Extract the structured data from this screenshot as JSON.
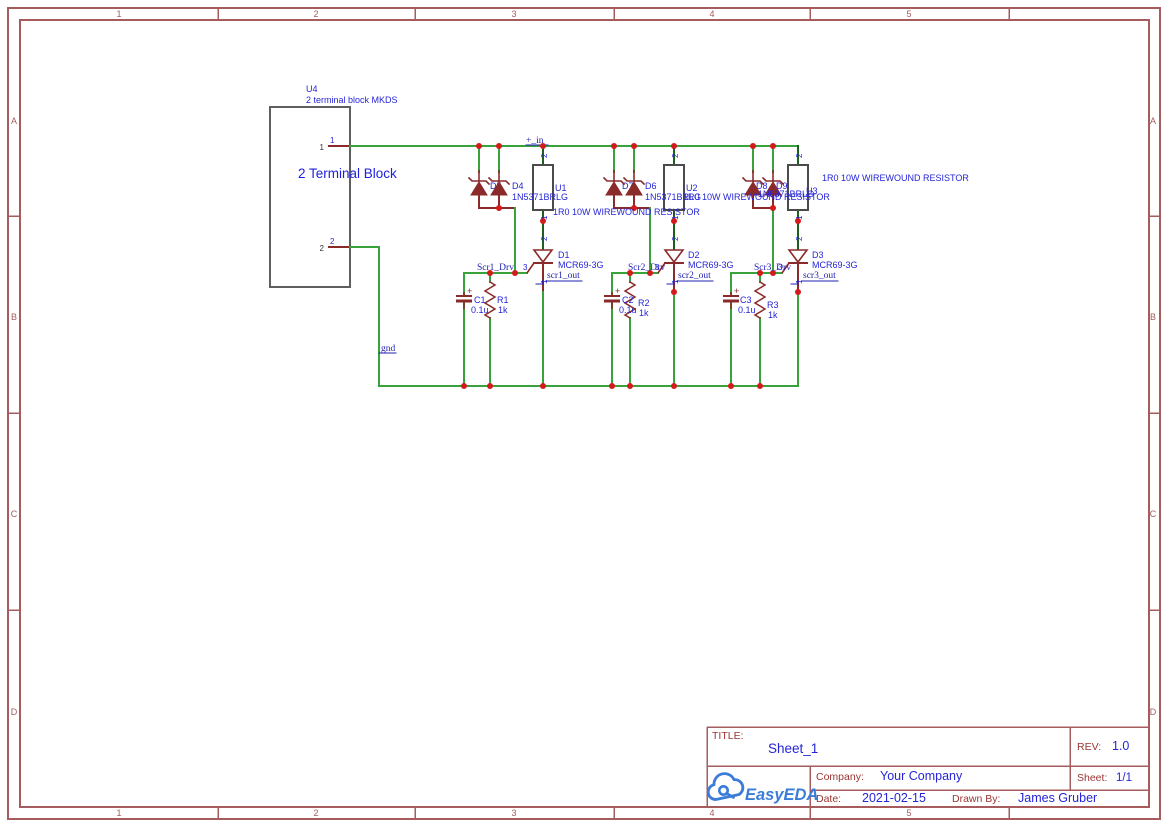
{
  "frame": {
    "columns": [
      "1",
      "2",
      "3",
      "4",
      "5"
    ],
    "rows": [
      "A",
      "B",
      "C",
      "D"
    ],
    "col_ticks": [
      218,
      415,
      614,
      810,
      1009
    ],
    "col_centers": [
      119,
      316,
      514,
      712,
      909
    ],
    "row_ticks": [
      216,
      413,
      610
    ],
    "row_centers": [
      121,
      317,
      514,
      712
    ],
    "color": "#a65c5c"
  },
  "title_block": {
    "title_label": "TITLE:",
    "title": "Sheet_1",
    "rev_label": "REV:",
    "rev": "1.0",
    "company_label": "Company:",
    "company": "Your Company",
    "sheet_label": "Sheet:",
    "sheet": "1/1",
    "date_label": "Date:",
    "date": "2021-02-15",
    "drawn_by_label": "Drawn By:",
    "drawn_by": "James Gruber",
    "logo_text": "EasyEDA"
  },
  "schematic": {
    "colors": {
      "wire": "#3aa23a",
      "dark": "#1e5e1e",
      "pin": "#8a2a2a",
      "junction": "#d41a1a",
      "lbl": "#2525d8",
      "lbl2": "#2020e0",
      "net": "#2222b2",
      "blk": "#333333",
      "box": "#4b4b4b",
      "body": "#5f5f5f"
    },
    "terminal_block": {
      "x": 270,
      "y": 107,
      "w": 80,
      "h": 180
    },
    "zeners": [
      479,
      499,
      614,
      634,
      753,
      773
    ],
    "scrs": [
      543,
      674,
      798
    ],
    "caps": [
      464,
      612,
      731
    ],
    "res_zigzag": [
      490,
      630,
      760
    ],
    "res_box": [
      543,
      674,
      798
    ],
    "wires": [
      {
        "c": "pin",
        "p": [
          [
            329,
            146
          ],
          [
            350,
            146
          ]
        ]
      },
      {
        "c": "pin",
        "p": [
          [
            329,
            247
          ],
          [
            350,
            247
          ]
        ]
      },
      {
        "c": "wire",
        "p": [
          [
            350,
            146
          ],
          [
            798,
            146
          ]
        ]
      },
      {
        "c": "wire",
        "p": [
          [
            350,
            247
          ],
          [
            379,
            247
          ],
          [
            379,
            386
          ],
          [
            798,
            386
          ]
        ]
      },
      {
        "c": "dark",
        "p": [
          [
            543,
            146
          ],
          [
            543,
            165
          ]
        ]
      },
      {
        "c": "dark",
        "p": [
          [
            674,
            146
          ],
          [
            674,
            165
          ]
        ]
      },
      {
        "c": "dark",
        "p": [
          [
            798,
            146
          ],
          [
            798,
            165
          ]
        ]
      },
      {
        "c": "dark",
        "p": [
          [
            543,
            210
          ],
          [
            543,
            250
          ]
        ]
      },
      {
        "c": "dark",
        "p": [
          [
            674,
            210
          ],
          [
            674,
            250
          ]
        ]
      },
      {
        "c": "dark",
        "p": [
          [
            798,
            210
          ],
          [
            798,
            250
          ]
        ]
      },
      {
        "c": "pin",
        "p": [
          [
            543,
            263
          ],
          [
            543,
            292
          ]
        ]
      },
      {
        "c": "pin",
        "p": [
          [
            674,
            263
          ],
          [
            674,
            292
          ]
        ]
      },
      {
        "c": "pin",
        "p": [
          [
            798,
            263
          ],
          [
            798,
            292
          ]
        ]
      },
      {
        "c": "wire",
        "p": [
          [
            543,
            292
          ],
          [
            543,
            386
          ]
        ]
      },
      {
        "c": "wire",
        "p": [
          [
            674,
            292
          ],
          [
            674,
            386
          ]
        ]
      },
      {
        "c": "wire",
        "p": [
          [
            798,
            292
          ],
          [
            798,
            386
          ]
        ]
      },
      {
        "c": "wire",
        "p": [
          [
            479,
            146
          ],
          [
            479,
            172
          ]
        ]
      },
      {
        "c": "wire",
        "p": [
          [
            499,
            146
          ],
          [
            499,
            172
          ]
        ]
      },
      {
        "c": "wire",
        "p": [
          [
            614,
            146
          ],
          [
            614,
            172
          ]
        ]
      },
      {
        "c": "wire",
        "p": [
          [
            634,
            146
          ],
          [
            634,
            172
          ]
        ]
      },
      {
        "c": "wire",
        "p": [
          [
            753,
            146
          ],
          [
            753,
            172
          ]
        ]
      },
      {
        "c": "wire",
        "p": [
          [
            773,
            146
          ],
          [
            773,
            172
          ]
        ]
      },
      {
        "c": "pin",
        "p": [
          [
            479,
            195
          ],
          [
            479,
            208
          ],
          [
            515,
            208
          ]
        ]
      },
      {
        "c": "pin",
        "p": [
          [
            499,
            195
          ],
          [
            499,
            208
          ]
        ]
      },
      {
        "c": "pin",
        "p": [
          [
            614,
            195
          ],
          [
            614,
            208
          ],
          [
            650,
            208
          ]
        ]
      },
      {
        "c": "pin",
        "p": [
          [
            634,
            195
          ],
          [
            634,
            208
          ]
        ]
      },
      {
        "c": "pin",
        "p": [
          [
            753,
            195
          ],
          [
            753,
            208
          ],
          [
            773,
            208
          ]
        ]
      },
      {
        "c": "pin",
        "p": [
          [
            773,
            195
          ],
          [
            773,
            208
          ]
        ]
      },
      {
        "c": "wire",
        "p": [
          [
            515,
            208
          ],
          [
            515,
            273
          ]
        ]
      },
      {
        "c": "wire",
        "p": [
          [
            650,
            208
          ],
          [
            650,
            273
          ]
        ]
      },
      {
        "c": "wire",
        "p": [
          [
            773,
            208
          ],
          [
            773,
            273
          ]
        ]
      },
      {
        "c": "wire",
        "p": [
          [
            464,
            273
          ],
          [
            527,
            273
          ]
        ]
      },
      {
        "c": "wire",
        "p": [
          [
            612,
            273
          ],
          [
            658,
            273
          ]
        ]
      },
      {
        "c": "wire",
        "p": [
          [
            731,
            273
          ],
          [
            782,
            273
          ]
        ]
      },
      {
        "c": "wire",
        "p": [
          [
            464,
            273
          ],
          [
            464,
            296
          ]
        ]
      },
      {
        "c": "wire",
        "p": [
          [
            612,
            273
          ],
          [
            612,
            296
          ]
        ]
      },
      {
        "c": "wire",
        "p": [
          [
            731,
            273
          ],
          [
            731,
            296
          ]
        ]
      },
      {
        "c": "wire",
        "p": [
          [
            464,
            301
          ],
          [
            464,
            386
          ]
        ]
      },
      {
        "c": "wire",
        "p": [
          [
            612,
            301
          ],
          [
            612,
            386
          ]
        ]
      },
      {
        "c": "wire",
        "p": [
          [
            731,
            301
          ],
          [
            731,
            386
          ]
        ]
      },
      {
        "c": "wire",
        "p": [
          [
            490,
            273
          ],
          [
            490,
            282
          ]
        ]
      },
      {
        "c": "wire",
        "p": [
          [
            630,
            273
          ],
          [
            630,
            282
          ]
        ]
      },
      {
        "c": "wire",
        "p": [
          [
            760,
            273
          ],
          [
            760,
            282
          ]
        ]
      },
      {
        "c": "wire",
        "p": [
          [
            490,
            318
          ],
          [
            490,
            386
          ]
        ]
      },
      {
        "c": "wire",
        "p": [
          [
            630,
            318
          ],
          [
            630,
            386
          ]
        ]
      },
      {
        "c": "wire",
        "p": [
          [
            760,
            318
          ],
          [
            760,
            386
          ]
        ]
      },
      {
        "c": "net",
        "w": 1,
        "p": [
          [
            536,
            284
          ],
          [
            543,
            284
          ],
          [
            543,
            280
          ]
        ]
      },
      {
        "c": "net",
        "w": 1,
        "p": [
          [
            667,
            284
          ],
          [
            674,
            284
          ],
          [
            674,
            280
          ]
        ]
      },
      {
        "c": "net",
        "w": 1,
        "p": [
          [
            791,
            284
          ],
          [
            798,
            284
          ],
          [
            798,
            280
          ]
        ]
      },
      {
        "c": "net",
        "w": 1,
        "p": [
          [
            546,
            281
          ],
          [
            582,
            281
          ]
        ]
      },
      {
        "c": "net",
        "w": 1,
        "p": [
          [
            677,
            281
          ],
          [
            713,
            281
          ]
        ]
      },
      {
        "c": "net",
        "w": 1,
        "p": [
          [
            802,
            281
          ],
          [
            838,
            281
          ]
        ]
      },
      {
        "c": "net",
        "w": 1,
        "p": [
          [
            526,
            145
          ],
          [
            548,
            145
          ]
        ]
      },
      {
        "c": "net",
        "w": 1,
        "p": [
          [
            379,
            353
          ],
          [
            396,
            353
          ]
        ]
      }
    ],
    "junctions": [
      [
        479,
        146
      ],
      [
        499,
        146
      ],
      [
        543,
        146
      ],
      [
        614,
        146
      ],
      [
        634,
        146
      ],
      [
        674,
        146
      ],
      [
        753,
        146
      ],
      [
        773,
        146
      ],
      [
        499,
        208
      ],
      [
        634,
        208
      ],
      [
        773,
        208
      ],
      [
        490,
        273
      ],
      [
        515,
        273
      ],
      [
        630,
        273
      ],
      [
        650,
        273
      ],
      [
        760,
        273
      ],
      [
        773,
        273
      ],
      [
        543,
        221
      ],
      [
        674,
        221
      ],
      [
        798,
        221
      ],
      [
        674,
        292
      ],
      [
        798,
        292
      ],
      [
        464,
        386
      ],
      [
        490,
        386
      ],
      [
        543,
        386
      ],
      [
        612,
        386
      ],
      [
        630,
        386
      ],
      [
        674,
        386
      ],
      [
        731,
        386
      ],
      [
        760,
        386
      ]
    ],
    "texts": [
      {
        "x": 306,
        "y": 92,
        "t": "U4"
      },
      {
        "x": 306,
        "y": 103,
        "t": "2 terminal block MKDS"
      },
      {
        "x": 298,
        "y": 178,
        "t": "2 Terminal Block",
        "s": 13.5,
        "c": "lbl2",
        "n": "terminal-block-name"
      },
      {
        "x": 324,
        "y": 150,
        "t": "1",
        "s": 8,
        "c": "blk",
        "a": "end"
      },
      {
        "x": 324,
        "y": 251,
        "t": "2",
        "s": 8,
        "c": "blk",
        "a": "end"
      },
      {
        "x": 330,
        "y": 143,
        "t": "1",
        "s": 8
      },
      {
        "x": 330,
        "y": 244,
        "t": "2",
        "s": 8
      },
      {
        "x": 490,
        "y": 189,
        "t": "D5",
        "pre": 1
      },
      {
        "x": 622,
        "y": 189,
        "t": "D7",
        "pre": 1
      },
      {
        "x": 756,
        "y": 189,
        "t": "D8",
        "pre": 1
      },
      {
        "x": 512,
        "y": 189,
        "t": "D4"
      },
      {
        "x": 645,
        "y": 189,
        "t": "D6"
      },
      {
        "x": 776,
        "y": 189,
        "t": "D9"
      },
      {
        "x": 512,
        "y": 200,
        "t": "1N5371BRLG"
      },
      {
        "x": 645,
        "y": 200,
        "t": "1N5371BRLG"
      },
      {
        "x": 758,
        "y": 197,
        "t": "1N5371BRLG"
      },
      {
        "x": 555,
        "y": 191,
        "t": "U1"
      },
      {
        "x": 686,
        "y": 191,
        "t": "U2"
      },
      {
        "x": 806,
        "y": 194,
        "t": "U3"
      },
      {
        "x": 553,
        "y": 215,
        "t": "1R0 10W WIREWOUND RESISTOR"
      },
      {
        "x": 683,
        "y": 200,
        "t": "1R0 10W WIREWOUND RESISTOR"
      },
      {
        "x": 822,
        "y": 181,
        "t": "1R0 10W WIREWOUND RESISTOR"
      },
      {
        "x": 558,
        "y": 258,
        "t": "D1"
      },
      {
        "x": 688,
        "y": 258,
        "t": "D2"
      },
      {
        "x": 812,
        "y": 258,
        "t": "D3"
      },
      {
        "x": 558,
        "y": 268,
        "t": "MCR69-3G"
      },
      {
        "x": 688,
        "y": 268,
        "t": "MCR69-3G"
      },
      {
        "x": 812,
        "y": 268,
        "t": "MCR69-3G"
      },
      {
        "x": 474,
        "y": 303,
        "t": "C1"
      },
      {
        "x": 471,
        "y": 313,
        "t": "0.1u"
      },
      {
        "x": 497,
        "y": 303,
        "t": "R1"
      },
      {
        "x": 498,
        "y": 313,
        "t": "1k"
      },
      {
        "x": 622,
        "y": 303,
        "t": "C2"
      },
      {
        "x": 619,
        "y": 313,
        "t": "0.1u"
      },
      {
        "x": 638,
        "y": 306,
        "t": "R2"
      },
      {
        "x": 639,
        "y": 316,
        "t": "1k"
      },
      {
        "x": 740,
        "y": 303,
        "t": "C3"
      },
      {
        "x": 738,
        "y": 313,
        "t": "0.1u"
      },
      {
        "x": 767,
        "y": 308,
        "t": "R3"
      },
      {
        "x": 768,
        "y": 318,
        "t": "1k"
      },
      {
        "x": 523,
        "y": 270,
        "t": "3",
        "s": 8
      },
      {
        "x": 655,
        "y": 270,
        "t": "3",
        "s": 8
      },
      {
        "x": 778,
        "y": 270,
        "t": "3",
        "s": 8
      },
      {
        "x": 547,
        "y": 158,
        "t": "2",
        "s": 8,
        "r": 1
      },
      {
        "x": 547,
        "y": 220,
        "t": "1",
        "s": 8,
        "r": 1
      },
      {
        "x": 547,
        "y": 241,
        "t": "2",
        "s": 8,
        "r": 1
      },
      {
        "x": 547,
        "y": 284,
        "t": "1",
        "s": 8,
        "r": 1
      },
      {
        "x": 678,
        "y": 158,
        "t": "2",
        "s": 8,
        "r": 1
      },
      {
        "x": 678,
        "y": 220,
        "t": "1",
        "s": 8,
        "r": 1
      },
      {
        "x": 678,
        "y": 241,
        "t": "2",
        "s": 8,
        "r": 1
      },
      {
        "x": 678,
        "y": 284,
        "t": "1",
        "s": 8,
        "r": 1
      },
      {
        "x": 802,
        "y": 158,
        "t": "2",
        "s": 8,
        "r": 1
      },
      {
        "x": 802,
        "y": 220,
        "t": "1",
        "s": 8,
        "r": 1
      },
      {
        "x": 802,
        "y": 241,
        "t": "2",
        "s": 8,
        "r": 1
      },
      {
        "x": 802,
        "y": 284,
        "t": "1",
        "s": 8,
        "r": 1
      },
      {
        "x": 526,
        "y": 143,
        "t": "+_in",
        "c": "net",
        "f": "serif",
        "s": 9.5,
        "n": "net-label-plus-in"
      },
      {
        "x": 477,
        "y": 270,
        "t": "Scr1_Drv",
        "c": "net",
        "f": "serif",
        "s": 9.5,
        "n": "net-label-scr1-drv"
      },
      {
        "x": 628,
        "y": 270,
        "t": "Scr2_Drv",
        "c": "net",
        "f": "serif",
        "s": 9.5,
        "n": "net-label-scr2-drv"
      },
      {
        "x": 754,
        "y": 270,
        "t": "Scr3_Drv",
        "c": "net",
        "f": "serif",
        "s": 9.5,
        "n": "net-label-scr3-drv"
      },
      {
        "x": 547,
        "y": 278,
        "t": "scr1_out",
        "c": "net",
        "f": "serif",
        "s": 9.5,
        "n": "net-label-scr1-out"
      },
      {
        "x": 678,
        "y": 278,
        "t": "scr2_out",
        "c": "net",
        "f": "serif",
        "s": 9.5,
        "n": "net-label-scr2-out"
      },
      {
        "x": 803,
        "y": 278,
        "t": "scr3_out",
        "c": "net",
        "f": "serif",
        "s": 9.5,
        "n": "net-label-scr3-out"
      },
      {
        "x": 381,
        "y": 351,
        "t": "gnd",
        "c": "net",
        "f": "serif",
        "s": 9.5,
        "n": "net-label-gnd"
      }
    ]
  }
}
